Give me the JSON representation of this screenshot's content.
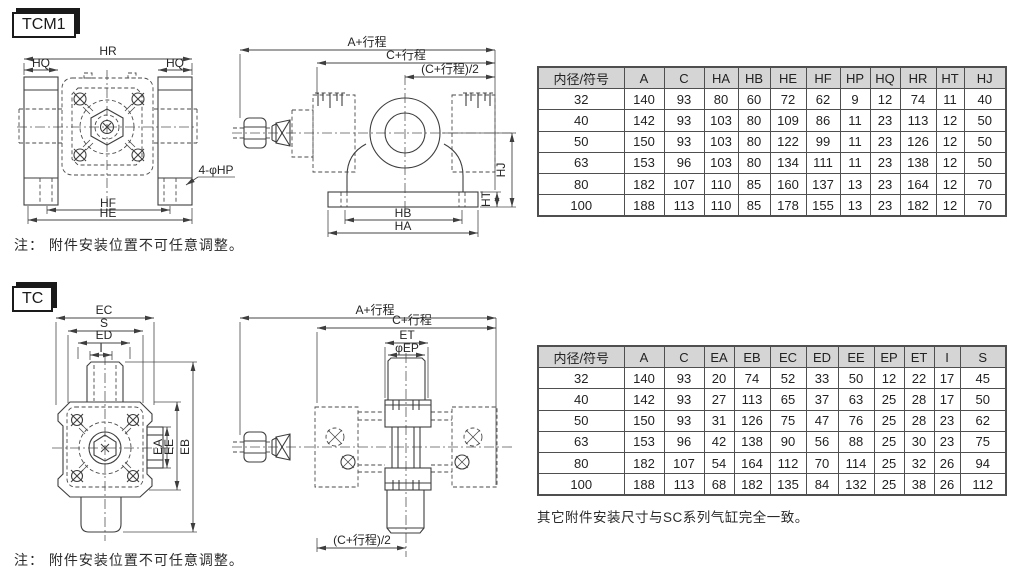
{
  "tcm1": {
    "title": "TCM1",
    "note": "注： 附件安装位置不可任意调整。",
    "front": {
      "hr": "HR",
      "hq_left": "HQ",
      "hq_right": "HQ",
      "hp_callout": "4-φHP",
      "hf": "HF",
      "he": "HE"
    },
    "side": {
      "a_stroke": "A+行程",
      "c_stroke": "C+行程",
      "c_stroke_half": "(C+行程)/2",
      "hj": "HJ",
      "ht": "HT",
      "hb": "HB",
      "ha": "HA"
    },
    "table": {
      "headers": [
        "内径/符号",
        "A",
        "C",
        "HA",
        "HB",
        "HE",
        "HF",
        "HP",
        "HQ",
        "HR",
        "HT",
        "HJ"
      ],
      "rows": [
        [
          "32",
          "140",
          "93",
          "80",
          "60",
          "72",
          "62",
          "9",
          "12",
          "74",
          "11",
          "40"
        ],
        [
          "40",
          "142",
          "93",
          "103",
          "80",
          "109",
          "86",
          "11",
          "23",
          "113",
          "12",
          "50"
        ],
        [
          "50",
          "150",
          "93",
          "103",
          "80",
          "122",
          "99",
          "11",
          "23",
          "126",
          "12",
          "50"
        ],
        [
          "63",
          "153",
          "96",
          "103",
          "80",
          "134",
          "111",
          "11",
          "23",
          "138",
          "12",
          "50"
        ],
        [
          "80",
          "182",
          "107",
          "110",
          "85",
          "160",
          "137",
          "13",
          "23",
          "164",
          "12",
          "70"
        ],
        [
          "100",
          "188",
          "113",
          "110",
          "85",
          "178",
          "155",
          "13",
          "23",
          "182",
          "12",
          "70"
        ]
      ]
    }
  },
  "tc": {
    "title": "TC",
    "note": "注： 附件安装位置不可任意调整。",
    "front": {
      "ec": "EC",
      "s": "S",
      "ed": "ED",
      "i": "I",
      "ea": "EA",
      "ee": "EE",
      "eb": "EB"
    },
    "side": {
      "a_stroke": "A+行程",
      "c_stroke": "C+行程",
      "et": "ET",
      "ep": "φEP",
      "c_stroke_half": "(C+行程)/2"
    },
    "table": {
      "headers": [
        "内径/符号",
        "A",
        "C",
        "EA",
        "EB",
        "EC",
        "ED",
        "EE",
        "EP",
        "ET",
        "I",
        "S"
      ],
      "rows": [
        [
          "32",
          "140",
          "93",
          "20",
          "74",
          "52",
          "33",
          "50",
          "12",
          "22",
          "17",
          "45"
        ],
        [
          "40",
          "142",
          "93",
          "27",
          "113",
          "65",
          "37",
          "63",
          "25",
          "28",
          "17",
          "50"
        ],
        [
          "50",
          "150",
          "93",
          "31",
          "126",
          "75",
          "47",
          "76",
          "25",
          "28",
          "23",
          "62"
        ],
        [
          "63",
          "153",
          "96",
          "42",
          "138",
          "90",
          "56",
          "88",
          "25",
          "30",
          "23",
          "75"
        ],
        [
          "80",
          "182",
          "107",
          "54",
          "164",
          "112",
          "70",
          "114",
          "25",
          "32",
          "26",
          "94"
        ],
        [
          "100",
          "188",
          "113",
          "68",
          "182",
          "135",
          "84",
          "132",
          "25",
          "38",
          "26",
          "112"
        ]
      ]
    },
    "footnote": "其它附件安装尺寸与SC系列气缸完全一致。"
  },
  "colors": {
    "line": "#3e3e3e",
    "table_border": "#4f4f4f",
    "header_bg": "#d5d5d5",
    "text": "#222222"
  }
}
